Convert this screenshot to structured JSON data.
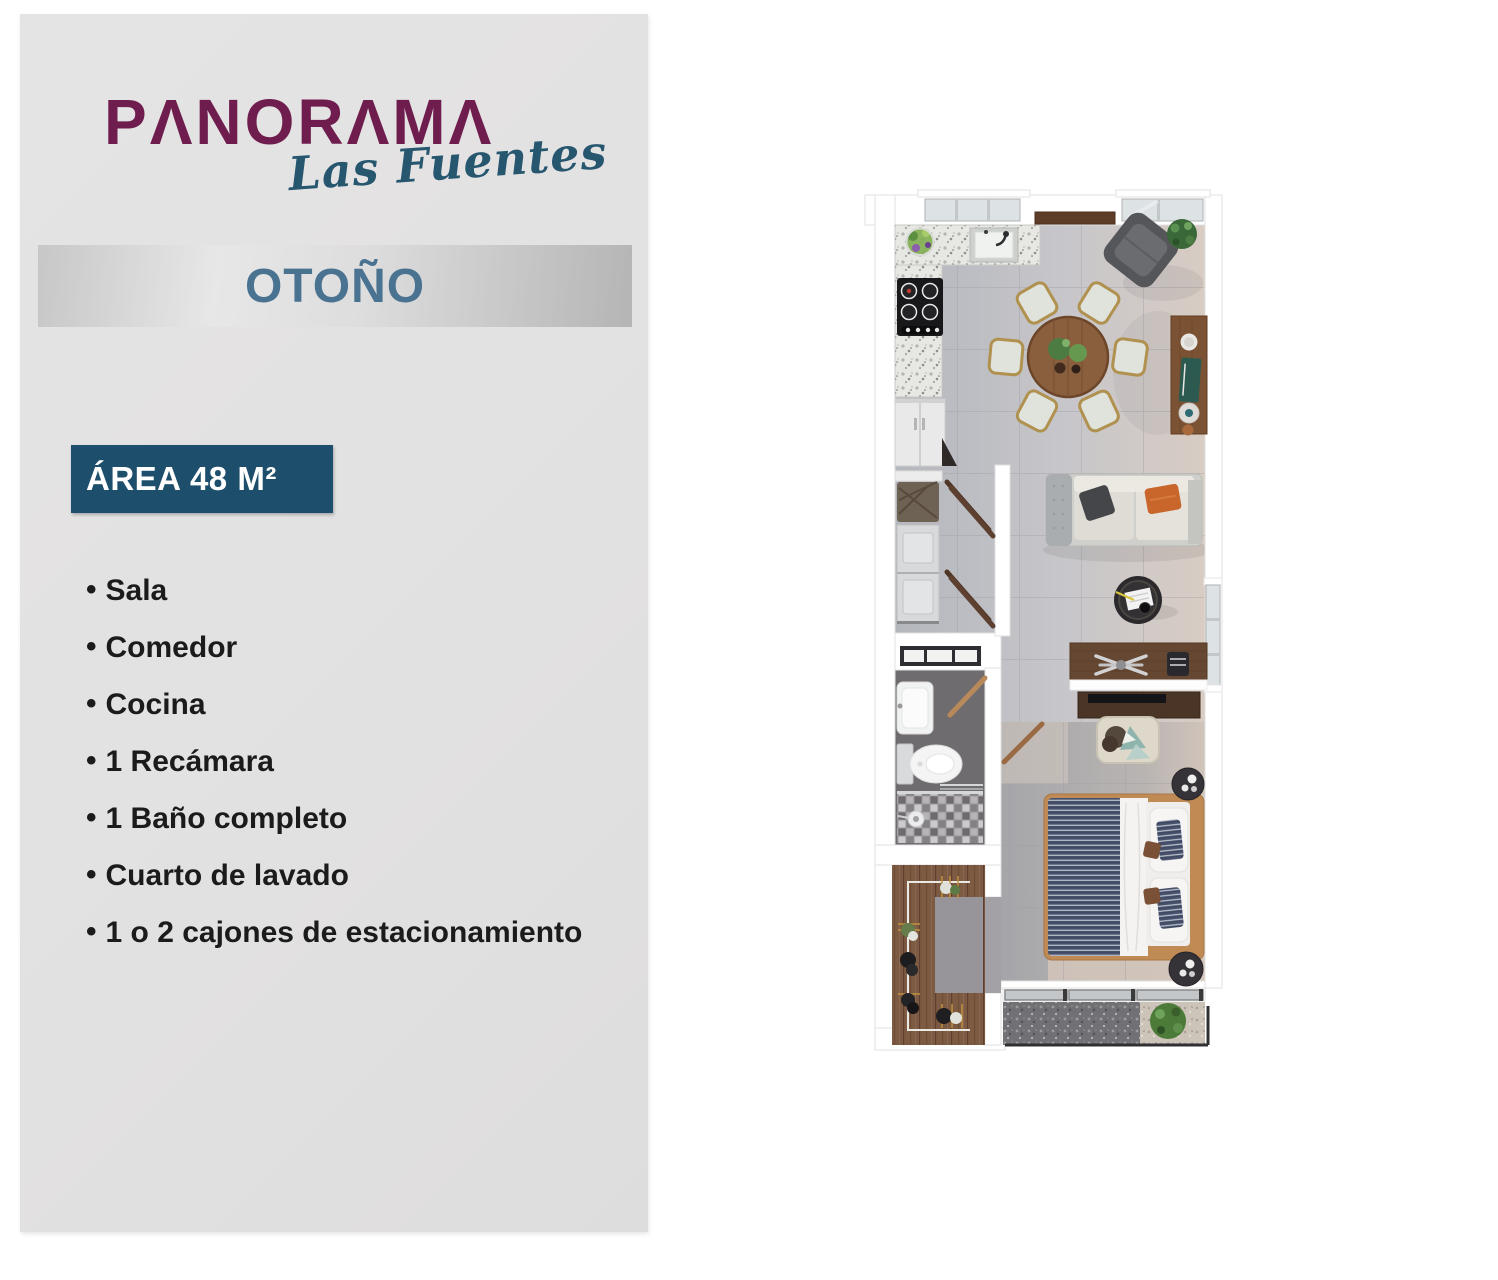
{
  "brand": {
    "wordmark": "PANORAMA",
    "script": "Las Fuentes"
  },
  "unit": {
    "name": "OTOÑO",
    "area": "ÁREA 48 M²"
  },
  "features": {
    "items": [
      "Sala",
      "Comedor",
      "Cocina",
      "1 Recámara",
      "1 Baño completo",
      "Cuarto de lavado",
      "1 o 2 cajones de estacionamiento"
    ]
  },
  "colors": {
    "brand_plum": "#6E1D4E",
    "brand_teal": "#27566F",
    "banner_text_blue": "#4A7291",
    "banner_gradient_gray": "#C7C7C7",
    "area_badge_bg": "#1D4E6B",
    "panel_bg": "#E3E2E2",
    "feature_text": "#1B1B1B"
  }
}
